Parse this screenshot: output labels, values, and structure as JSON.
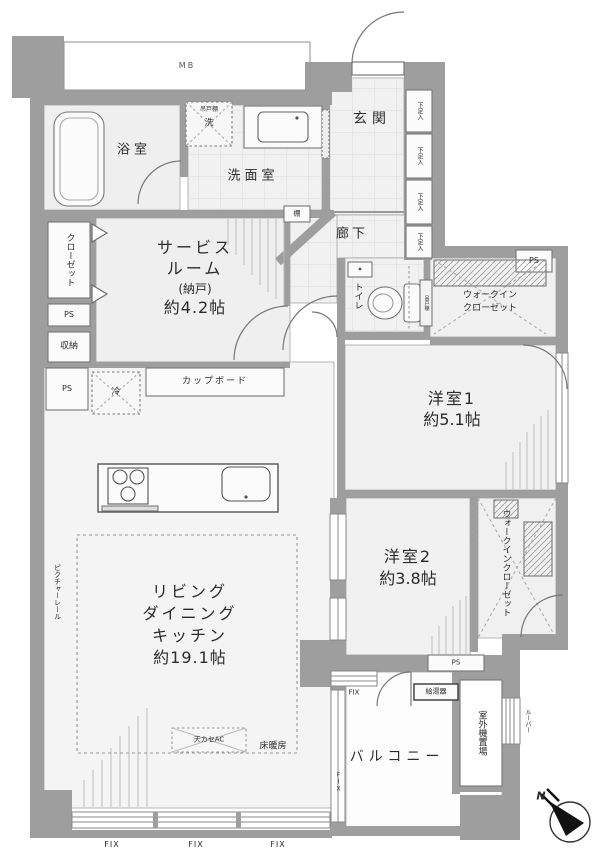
{
  "labels": {
    "mb": "MB",
    "bathroom": "浴室",
    "washroom": "洗面室",
    "hanging_cabinet": "吊戸棚",
    "washer": "洗",
    "entrance": "玄関",
    "corridor": "廊下",
    "closet": "クローゼット",
    "ps": "PS",
    "storage": "収納",
    "service_room_l1": "サービス",
    "service_room_l2": "ルーム",
    "service_room_l3": "(納戸)",
    "service_room_l4": "約4.2帖",
    "cupboard": "カップボード",
    "fridge": "冷",
    "shelf": "棚",
    "shoe_box": "下足入",
    "toilet": "トイレ",
    "toilet_cabinet": "吊戸棚",
    "wic_l1": "ウォークイン",
    "wic_l2": "クローゼット",
    "bedroom1_name": "洋室1",
    "bedroom1_size": "約5.1帖",
    "bedroom2_name": "洋室2",
    "bedroom2_size": "約3.8帖",
    "ldk_l1": "リビング",
    "ldk_l2": "ダイニング",
    "ldk_l3": "キッチン",
    "ldk_l4": "約19.1帖",
    "floor_heating": "床暖房",
    "ceiling_ac": "天カセAC",
    "picture_rail": "ピクチャーレール",
    "water_heater": "給湯器",
    "outdoor_unit": "室外機置場",
    "louver": "ルーバー",
    "balcony": "バルコニー",
    "fix": "FIX",
    "compass_north": "N"
  },
  "colors": {
    "wall": "#9e9e9e",
    "floor": "#f2f2f2",
    "line": "#777777"
  }
}
